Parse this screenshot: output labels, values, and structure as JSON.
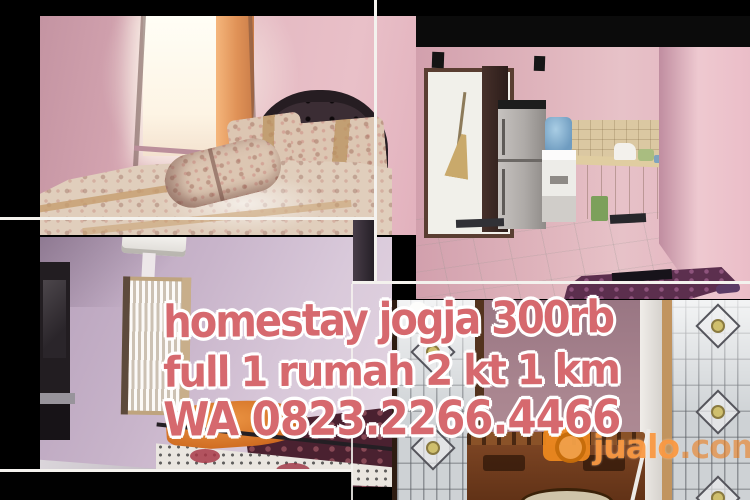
{
  "overlay": {
    "line1": "homestay jogja 300rb",
    "line2": "full 1 rumah 2 kt 1 km",
    "line3": "WA 0823.2266.4466"
  },
  "watermark": {
    "site": "jualo",
    "tld": ".com",
    "icon": "camera-icon"
  },
  "kitchen": {
    "wall_marking": "1"
  },
  "photos": {
    "top_left": "pink-bedroom-with-floral-double-bed",
    "top_right": "kitchen-with-fridge-and-water-dispenser",
    "bottom_left": "bedroom-with-ac-window-and-tv",
    "bottom_right": "room-with-stained-glass-windows-and-wooden-bench"
  },
  "palette": {
    "overlay_text": "#d6696e",
    "overlay_outline": "#ffffff",
    "brand_orange": "#f08a1e",
    "wall_pink": "#e0b1bd",
    "wall_lavender": "#cdb9ce",
    "wall_mauve": "#aa8690",
    "band_black": "#000000"
  }
}
